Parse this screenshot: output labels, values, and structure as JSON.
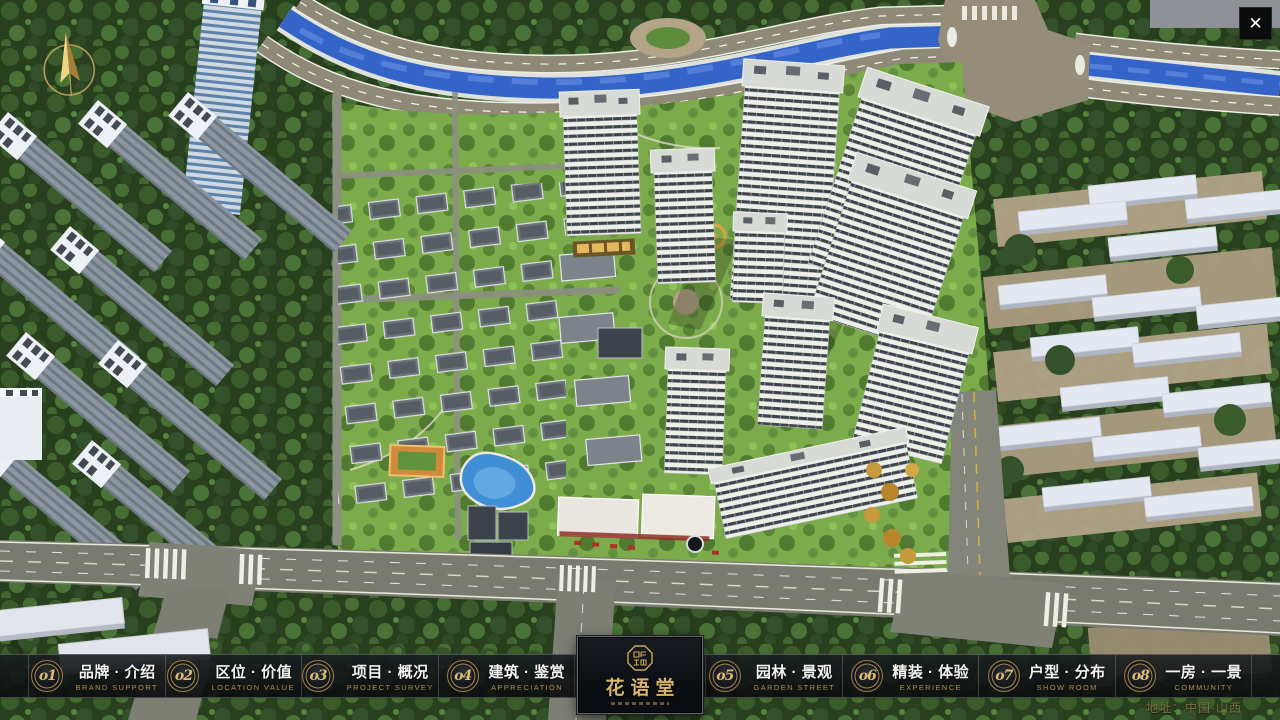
{
  "chrome": {
    "close_glyph": "✕"
  },
  "nav": {
    "items": [
      {
        "num": "o1",
        "label": "品牌 · 介绍",
        "caption": "BRAND SUPPORT"
      },
      {
        "num": "o2",
        "label": "区位 · 价值",
        "caption": "LOCATION VALUE"
      },
      {
        "num": "o3",
        "label": "项目 · 概况",
        "caption": "PROJECT SURVEY"
      },
      {
        "num": "o4",
        "label": "建筑 · 鉴赏",
        "caption": "APPRECIATION"
      },
      {
        "num": "o5",
        "label": "园林 · 景观",
        "caption": "GARDEN STREET"
      },
      {
        "num": "o6",
        "label": "精装 · 体验",
        "caption": "EXPERIENCE"
      },
      {
        "num": "o7",
        "label": "户型 · 分布",
        "caption": "SHOW ROOM"
      },
      {
        "num": "o8",
        "label": "一房 · 一景",
        "caption": "COMMUNITY"
      }
    ]
  },
  "logo": {
    "title": "花语堂"
  },
  "footer": {
    "address": "地址：中国·山西"
  },
  "icons": {
    "compass": "compass-north-arrow",
    "seal": "brand-seal-octagon"
  },
  "colors": {
    "accent_gold": "#cdab5e",
    "navbar_bg": "#0e1216",
    "river_blue": "#3464c8",
    "lawn_green": "#7cab4c",
    "road_grey": "#797b71"
  }
}
